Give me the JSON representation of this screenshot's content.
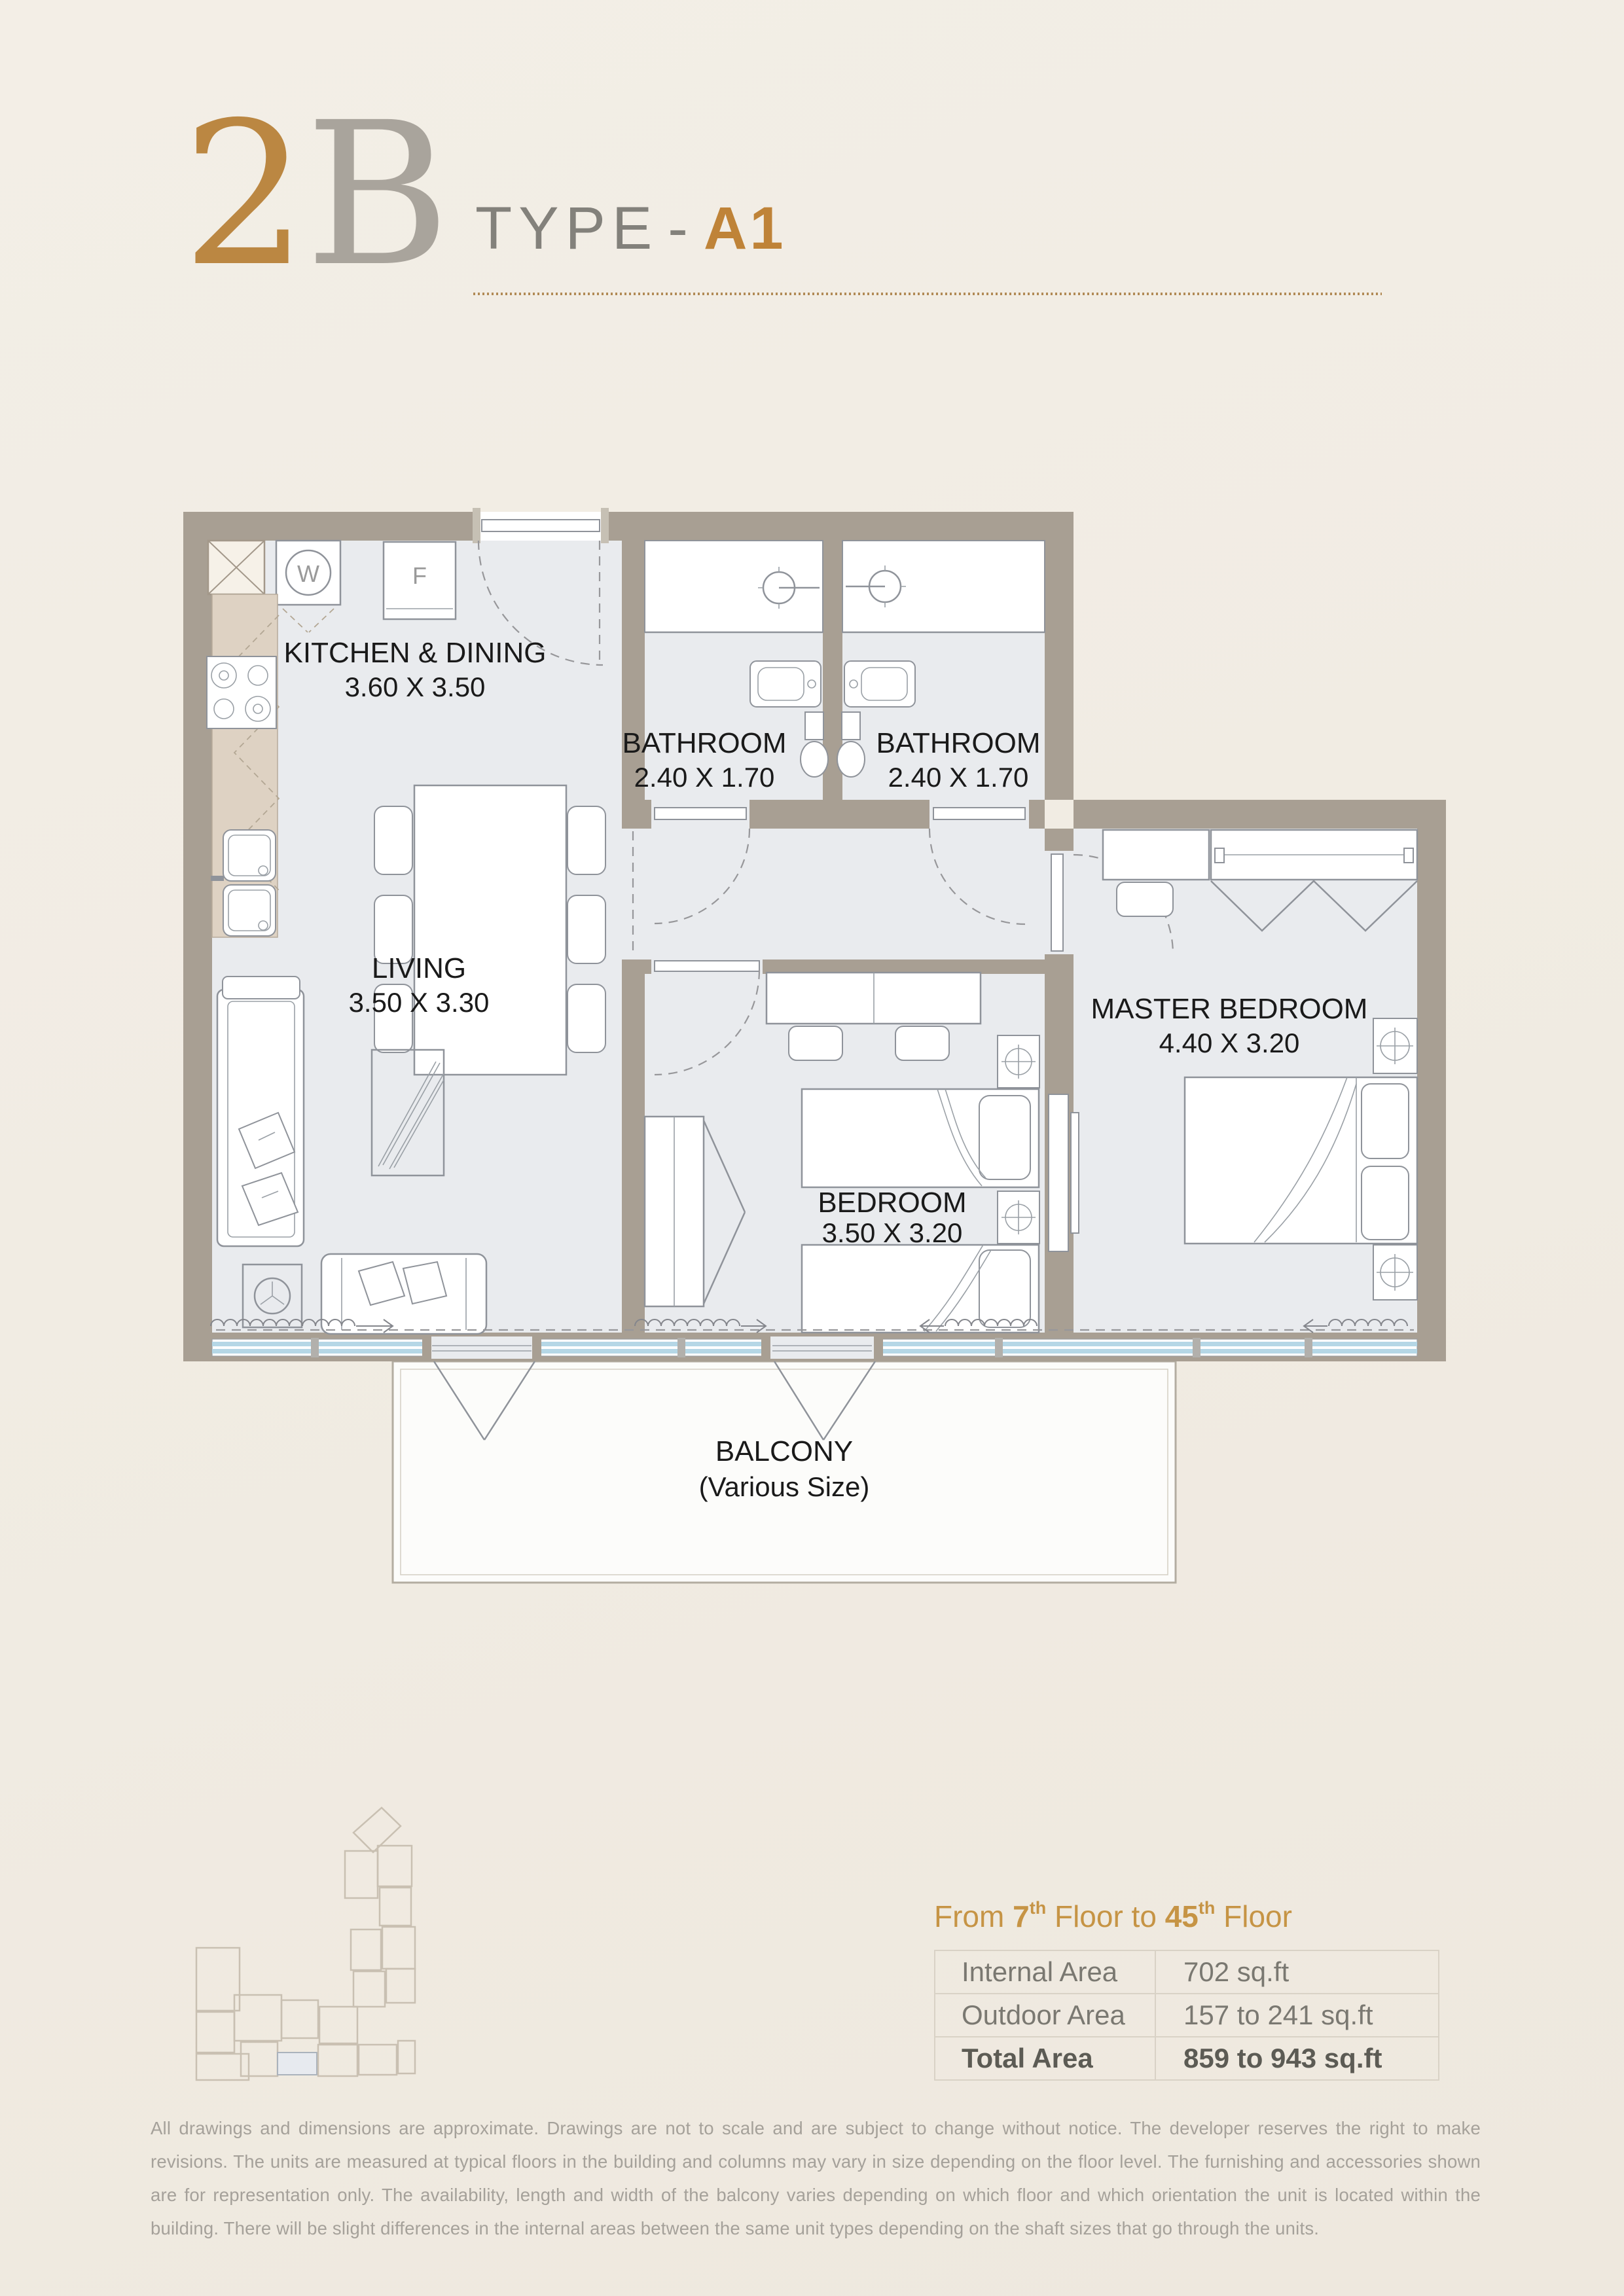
{
  "title": {
    "number": "2",
    "letter": "B",
    "type_label": "TYPE",
    "separator": "-",
    "type_value": "A1"
  },
  "floor_range": {
    "word_from": "From ",
    "from_number": "7",
    "from_ordinal": "th",
    "word_floor_to": " Floor to ",
    "to_number": "45",
    "to_ordinal": "th",
    "word_floor": " Floor"
  },
  "area_table": {
    "rows": [
      {
        "label": "Internal Area",
        "value": "702 sq.ft"
      },
      {
        "label": "Outdoor Area",
        "value": "157 to 241 sq.ft"
      },
      {
        "label": "Total Area",
        "value": "859 to 943 sq.ft"
      }
    ]
  },
  "rooms": {
    "kitchen": {
      "name": "KITCHEN & DINING",
      "dims": "3.60 X 3.50"
    },
    "bath1": {
      "name": "BATHROOM",
      "dims": "2.40 X 1.70"
    },
    "bath2": {
      "name": "BATHROOM",
      "dims": "2.40 X 1.70"
    },
    "living": {
      "name": "LIVING",
      "dims": "3.50 X 3.30"
    },
    "bedroom": {
      "name": "BEDROOM",
      "dims": "3.50 X 3.20"
    },
    "master": {
      "name": "MASTER BEDROOM",
      "dims": "4.40 X 3.20"
    },
    "balcony": {
      "name": "BALCONY",
      "note": "(Various Size)"
    }
  },
  "appliances": {
    "washer": "W",
    "fridge": "F"
  },
  "disclaimer": "All drawings and dimensions are approximate. Drawings are not to scale and are subject to change without notice. The developer reserves the right to make revisions. The units are measured at typical floors in the building and columns may vary in size depending on the floor level. The furnishing and accessories shown are for representation only. The availability, length and width of the balcony varies depending on which floor and which orientation the unit is located within the building. There will be slight differences in the internal areas between the same unit types depending on the shaft sizes that go through the units.",
  "colors": {
    "accent_gold": "#bf8338",
    "title_number_gold": "#bb8742",
    "title_letter_gray": "#a9a49c",
    "wall_taupe": "#a89f93",
    "floor_gray": "#e9ebee",
    "counter_beige": "#ded2c3",
    "glazing_blue": "#b5d7e6",
    "heading_gold": "#c69445",
    "highlighted_unit": "#e7eaef"
  }
}
